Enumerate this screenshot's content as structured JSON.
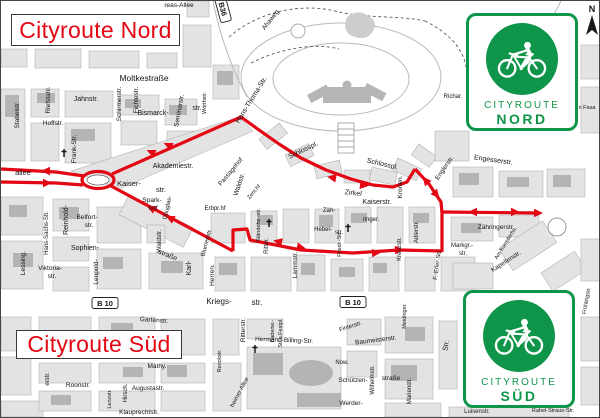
{
  "titles": {
    "nord": "Cityroute Nord",
    "sued": "Cityroute Süd",
    "color": "#e30613"
  },
  "signs": {
    "green": "#0f9549",
    "nord": {
      "line1": "CITYROUTE",
      "line2": "NORD"
    },
    "sued": {
      "line1": "CITYROUTE",
      "line2": "SÜD"
    }
  },
  "compass": {
    "label": "N"
  },
  "map": {
    "route_color": "#e30613",
    "roundabout": {
      "cx": 97,
      "cy": 179,
      "rx": 16,
      "ry": 8.5,
      "irx": 11,
      "iry": 5
    },
    "routes": [
      {
        "n": "nord-west-upper",
        "pts": [
          [
            0,
            168
          ],
          [
            55,
            171
          ],
          [
            83,
            175
          ]
        ]
      },
      {
        "n": "nord-west-lower",
        "pts": [
          [
            0,
            181
          ],
          [
            55,
            182
          ],
          [
            82,
            184
          ]
        ]
      },
      {
        "n": "nord-diagonal",
        "pts": [
          [
            111,
            173
          ],
          [
            240,
            116
          ]
        ]
      },
      {
        "n": "nord-zirkel-arc",
        "pts": [
          [
            240,
            116
          ],
          [
            258,
            129
          ],
          [
            278,
            143
          ],
          [
            300,
            157
          ],
          [
            325,
            169
          ],
          [
            350,
            178
          ],
          [
            372,
            184
          ],
          [
            392,
            186
          ],
          [
            406,
            181
          ],
          [
            414,
            168
          ]
        ]
      },
      {
        "n": "nord-engler",
        "pts": [
          [
            414,
            168
          ],
          [
            428,
            183
          ],
          [
            440,
            201
          ],
          [
            441,
            212
          ]
        ]
      },
      {
        "n": "nord-east",
        "pts": [
          [
            441,
            211
          ],
          [
            538,
            212
          ]
        ]
      },
      {
        "n": "connector-fritz-erler",
        "pts": [
          [
            441,
            211
          ],
          [
            441,
            251
          ]
        ]
      },
      {
        "n": "sued-diagonal",
        "pts": [
          [
            110,
            185
          ],
          [
            232,
            250
          ]
        ]
      },
      {
        "n": "sued-east",
        "pts": [
          [
            232,
            250
          ],
          [
            232,
            229
          ],
          [
            246,
            228
          ],
          [
            249,
            239
          ],
          [
            300,
            249
          ],
          [
            352,
            252
          ],
          [
            398,
            249
          ],
          [
            441,
            250
          ]
        ]
      }
    ],
    "arrows": [
      {
        "x": 47,
        "y": 170,
        "a": 180
      },
      {
        "x": 44,
        "y": 182,
        "a": 0
      },
      {
        "x": 152,
        "y": 152,
        "a": 205
      },
      {
        "x": 169,
        "y": 145,
        "a": 205
      },
      {
        "x": 333,
        "y": 177,
        "a": 190
      },
      {
        "x": 361,
        "y": 184,
        "a": 6
      },
      {
        "x": 426,
        "y": 181,
        "a": 230
      },
      {
        "x": 434,
        "y": 192,
        "a": 50
      },
      {
        "x": 474,
        "y": 211,
        "a": 180
      },
      {
        "x": 512,
        "y": 211,
        "a": 0
      },
      {
        "x": 535,
        "y": 212,
        "a": 0
      },
      {
        "x": 152,
        "y": 208,
        "a": 207
      },
      {
        "x": 171,
        "y": 218,
        "a": 207
      },
      {
        "x": 279,
        "y": 241,
        "a": 192
      },
      {
        "x": 298,
        "y": 246,
        "a": 12
      },
      {
        "x": 373,
        "y": 252,
        "a": 357
      },
      {
        "x": 396,
        "y": 249,
        "a": 357
      }
    ],
    "badges": [
      {
        "t": "B36",
        "x": 222,
        "y": 8,
        "r": 75
      },
      {
        "t": "B 10",
        "x": 104,
        "y": 302,
        "r": 0
      },
      {
        "t": "B 10",
        "x": 352,
        "y": 301,
        "r": 0
      }
    ],
    "crosses": [
      [
        63,
        152
      ],
      [
        268,
        222
      ],
      [
        347,
        227
      ],
      [
        254,
        348
      ]
    ],
    "labels": [
      {
        "t": "N",
        "x": 591,
        "y": 11,
        "s": 9,
        "b": 1
      },
      {
        "t": "Moltkestraße",
        "x": 143,
        "y": 80,
        "s": 8.5
      },
      {
        "t": "Jahnstr.",
        "x": 85,
        "y": 100,
        "s": 7
      },
      {
        "t": "Bismarck-",
        "x": 152,
        "y": 114,
        "s": 7
      },
      {
        "t": "str.",
        "x": 196,
        "y": 109,
        "s": 7
      },
      {
        "t": "Stabelstr.",
        "x": 18,
        "y": 114,
        "s": 6.5,
        "r": -90
      },
      {
        "t": "Riefstahl.",
        "x": 49,
        "y": 99,
        "s": 6.5,
        "r": -90
      },
      {
        "t": "Hoffstr.",
        "x": 52,
        "y": 124,
        "s": 6.5
      },
      {
        "t": "Schirmerstr.",
        "x": 120,
        "y": 103,
        "s": 6.5,
        "r": -90
      },
      {
        "t": "Fichtestr.",
        "x": 137,
        "y": 99,
        "s": 6.5,
        "r": -90
      },
      {
        "t": "Seminarstr.",
        "x": 180,
        "y": 110,
        "s": 6.5,
        "r": -80
      },
      {
        "t": "Frank-Str.",
        "x": 75,
        "y": 148,
        "s": 6.5,
        "r": -90
      },
      {
        "t": "Reinhold-",
        "x": 67,
        "y": 219,
        "s": 7,
        "r": -90
      },
      {
        "t": "Hans-Sachs-Str.",
        "x": 47,
        "y": 232,
        "s": 6,
        "r": -90
      },
      {
        "t": "Belfort-",
        "x": 86,
        "y": 218,
        "s": 6.5
      },
      {
        "t": "str.",
        "x": 88,
        "y": 226,
        "s": 6.5
      },
      {
        "t": "Sophien-",
        "x": 84,
        "y": 249,
        "s": 7
      },
      {
        "t": "straße",
        "x": 166,
        "y": 256,
        "s": 7,
        "r": 22
      },
      {
        "t": "Viktoria-",
        "x": 49,
        "y": 269,
        "s": 6.5
      },
      {
        "t": "str.",
        "x": 51,
        "y": 277,
        "s": 6.5
      },
      {
        "t": "Leopold-",
        "x": 97,
        "y": 271,
        "s": 6.5,
        "r": -90
      },
      {
        "t": "Lessing.",
        "x": 24,
        "y": 262,
        "s": 6.5,
        "r": -90
      },
      {
        "t": "allee",
        "x": 22,
        "y": 174,
        "s": 7.5
      },
      {
        "t": "Kaiser-",
        "x": 128,
        "y": 185,
        "s": 7.5
      },
      {
        "t": "str.",
        "x": 160,
        "y": 191,
        "s": 7.5
      },
      {
        "t": "Akademiestr.",
        "x": 172,
        "y": 167,
        "s": 7
      },
      {
        "t": "Spark-",
        "x": 151,
        "y": 201,
        "s": 6.5
      },
      {
        "t": "hof",
        "x": 152,
        "y": 209,
        "s": 6.5
      },
      {
        "t": "Douglas-",
        "x": 168,
        "y": 207,
        "s": 6,
        "r": -78
      },
      {
        "t": "Passagehof",
        "x": 231,
        "y": 172,
        "s": 6.5,
        "r": -50
      },
      {
        "t": "Waldstr.",
        "x": 240,
        "y": 184,
        "s": 6.5,
        "r": -72
      },
      {
        "t": "Waldstr.",
        "x": 160,
        "y": 240,
        "s": 6.5,
        "r": -90
      },
      {
        "t": "Zent.hf",
        "x": 254,
        "y": 192,
        "s": 5.5,
        "r": -50
      },
      {
        "t": "Zirkel",
        "x": 352,
        "y": 194,
        "s": 7,
        "r": 6
      },
      {
        "t": "Schlosspl.",
        "x": 303,
        "y": 151,
        "s": 7,
        "r": -26
      },
      {
        "t": "Schlosspl.",
        "x": 381,
        "y": 165,
        "s": 7,
        "r": 13
      },
      {
        "t": "Kaiserstr.",
        "x": 376,
        "y": 203,
        "s": 7
      },
      {
        "t": "Zäh-",
        "x": 328,
        "y": 211,
        "s": 6
      },
      {
        "t": "ringer.",
        "x": 370,
        "y": 220,
        "s": 6
      },
      {
        "t": "Ständehs.-str.",
        "x": 259,
        "y": 224,
        "s": 5.5,
        "r": -90
      },
      {
        "t": "Hebel-",
        "x": 322,
        "y": 230,
        "s": 6
      },
      {
        "t": "str.",
        "x": 338,
        "y": 233,
        "s": 6
      },
      {
        "t": "Friedr.-Str.",
        "x": 340,
        "y": 243,
        "s": 5.5,
        "r": -90
      },
      {
        "t": "Ritter.",
        "x": 267,
        "y": 245,
        "s": 6,
        "r": -90
      },
      {
        "t": "Lammstr.",
        "x": 296,
        "y": 264,
        "s": 6.5,
        "r": -90
      },
      {
        "t": "Herren.",
        "x": 213,
        "y": 274,
        "s": 6.5,
        "r": -90
      },
      {
        "t": "Karl-",
        "x": 190,
        "y": 267,
        "s": 7,
        "r": -90
      },
      {
        "t": "Erbpr.hf",
        "x": 214,
        "y": 209,
        "s": 6
      },
      {
        "t": "Blumenstr.",
        "x": 207,
        "y": 242,
        "s": 6,
        "r": -75
      },
      {
        "t": "Kronen.",
        "x": 401,
        "y": 186,
        "s": 6.5,
        "r": -90
      },
      {
        "t": "Adlerstr.",
        "x": 417,
        "y": 231,
        "s": 6,
        "r": -90
      },
      {
        "t": "Kreuzstr.",
        "x": 400,
        "y": 248,
        "s": 6,
        "r": -90
      },
      {
        "t": "Markgr.-",
        "x": 461,
        "y": 246,
        "s": 6
      },
      {
        "t": "str.",
        "x": 462,
        "y": 254,
        "s": 6
      },
      {
        "t": "F.-Erler-Str.",
        "x": 438,
        "y": 264,
        "s": 6,
        "r": -82
      },
      {
        "t": "Zähringerstr.",
        "x": 495,
        "y": 228,
        "s": 6.5
      },
      {
        "t": "Am Künstlerhs.",
        "x": 506,
        "y": 243,
        "s": 5.5,
        "r": -58
      },
      {
        "t": "Kapellenstr.",
        "x": 506,
        "y": 262,
        "s": 6.5,
        "r": -33
      },
      {
        "t": "Engesserstr.",
        "x": 492,
        "y": 161,
        "s": 7,
        "r": 8
      },
      {
        "t": "Englerstr.",
        "x": 445,
        "y": 168,
        "s": 6.5,
        "r": -55
      },
      {
        "t": "Hans-Thoma-Str.",
        "x": 252,
        "y": 100,
        "s": 7,
        "r": -58
      },
      {
        "t": "Ahaweg",
        "x": 271,
        "y": 20,
        "s": 6.5,
        "r": -52
      },
      {
        "t": "reas-Allee",
        "x": 178,
        "y": 6,
        "s": 6.5
      },
      {
        "t": "Richar.",
        "x": 452,
        "y": 97,
        "s": 6
      },
      {
        "t": "n Fasa",
        "x": 586,
        "y": 108,
        "s": 5.5
      },
      {
        "t": "Wörthstr.",
        "x": 205,
        "y": 102,
        "s": 5.5,
        "r": -90
      },
      {
        "t": "Kriegs-",
        "x": 218,
        "y": 303,
        "s": 8
      },
      {
        "t": "str.",
        "x": 256,
        "y": 304,
        "s": 8
      },
      {
        "t": "Gartenstr.",
        "x": 153,
        "y": 321,
        "s": 6.5,
        "r": 4
      },
      {
        "t": "Roonstr.",
        "x": 77,
        "y": 386,
        "s": 6.5
      },
      {
        "t": "Augustastr.",
        "x": 147,
        "y": 389,
        "s": 6.5
      },
      {
        "t": "Mathy.",
        "x": 156,
        "y": 367,
        "s": 6.5
      },
      {
        "t": "Klauprechtstr.",
        "x": 138,
        "y": 413,
        "s": 6.5
      },
      {
        "t": "Lenzstr.",
        "x": 110,
        "y": 398,
        "s": 5.5,
        "r": -90
      },
      {
        "t": "Hirsch.",
        "x": 126,
        "y": 392,
        "s": 6,
        "r": -90
      },
      {
        "t": "erstr.",
        "x": 48,
        "y": 378,
        "s": 6,
        "r": -90
      },
      {
        "t": "Badenw.-",
        "x": 273,
        "y": 330,
        "s": 5.5,
        "r": -90
      },
      {
        "t": "Str.a.Festpl.",
        "x": 281,
        "y": 332,
        "s": 5.5,
        "r": -90
      },
      {
        "t": "Ritterstr.",
        "x": 244,
        "y": 329,
        "s": 6.5,
        "r": -90
      },
      {
        "t": "Hermann-Billing-Str.",
        "x": 283,
        "y": 341,
        "s": 6.5,
        "r": 2
      },
      {
        "t": "Baumeisterstr.",
        "x": 375,
        "y": 341,
        "s": 6.5,
        "r": -7
      },
      {
        "t": "Finterstr.",
        "x": 350,
        "y": 327,
        "s": 6,
        "r": -18
      },
      {
        "t": "Schützen-",
        "x": 352,
        "y": 381,
        "s": 6.5
      },
      {
        "t": "straße",
        "x": 390,
        "y": 379,
        "s": 6.5
      },
      {
        "t": "Werder-",
        "x": 350,
        "y": 404,
        "s": 6.5
      },
      {
        "t": "Wilhelmstr.",
        "x": 373,
        "y": 379,
        "s": 6,
        "r": -90
      },
      {
        "t": "Now.",
        "x": 341,
        "y": 363,
        "s": 6
      },
      {
        "t": "Renckstr.",
        "x": 220,
        "y": 360,
        "s": 5.5,
        "r": -90
      },
      {
        "t": "heimer Allee",
        "x": 240,
        "y": 392,
        "s": 6,
        "r": -62
      },
      {
        "t": "Meidinger.",
        "x": 405,
        "y": 315,
        "s": 5.5,
        "r": -90
      },
      {
        "t": "Marienstr.",
        "x": 410,
        "y": 390,
        "s": 6,
        "r": -90
      },
      {
        "t": "Str.",
        "x": 447,
        "y": 345,
        "s": 7,
        "r": -80
      },
      {
        "t": "Luisenstr.",
        "x": 476,
        "y": 412,
        "s": 6
      },
      {
        "t": "Rahel-Straus-Str.",
        "x": 552,
        "y": 411,
        "s": 5.5
      },
      {
        "t": "Frühlingstr.",
        "x": 587,
        "y": 300,
        "s": 5.5,
        "r": -80
      }
    ]
  }
}
